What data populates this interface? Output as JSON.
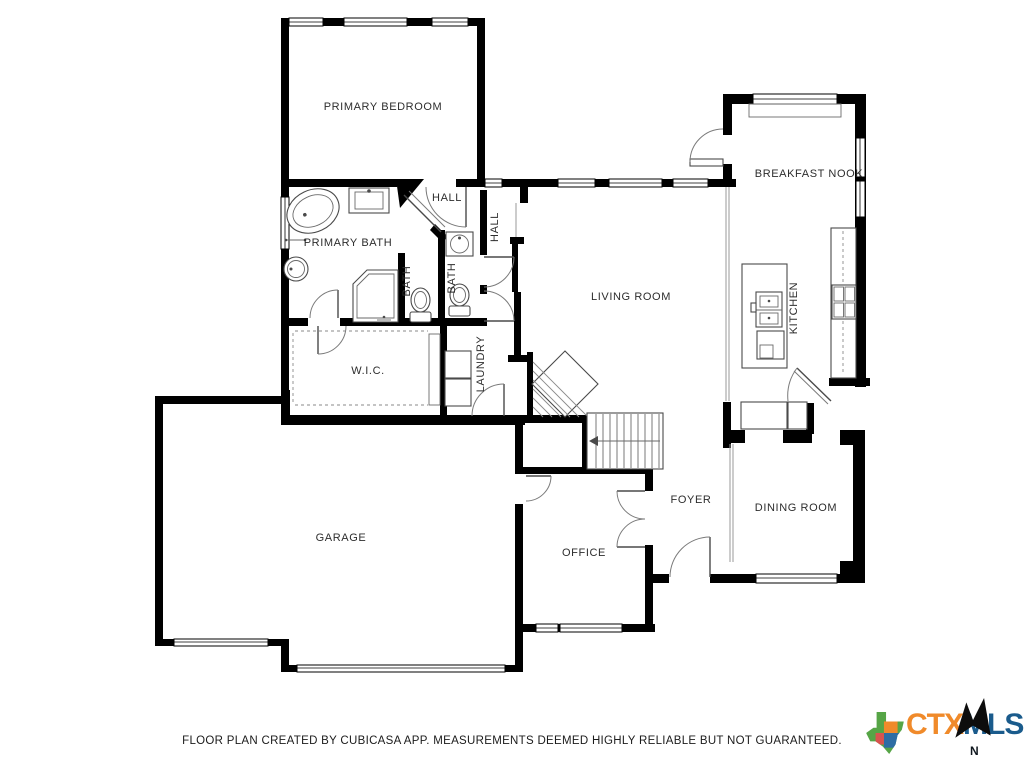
{
  "plan": {
    "rooms": {
      "primary_bedroom": "PRIMARY BEDROOM",
      "hall_upper": "HALL",
      "hall_side": "HALL",
      "primary_bath": "PRIMARY BATH",
      "bath_inner": "BATH",
      "bath_hall": "BATH",
      "living_room": "LIVING ROOM",
      "breakfast_nook": "BREAKFAST NOOK",
      "kitchen": "KITCHEN",
      "wic": "W.I.C.",
      "laundry": "LAUNDRY",
      "garage": "GARAGE",
      "office": "OFFICE",
      "foyer": "FOYER",
      "dining_room": "DINING ROOM"
    },
    "fixtures": [
      "bathtub",
      "shower",
      "toilet",
      "sink",
      "double-sink",
      "kitchen-island",
      "stove",
      "counter",
      "washer",
      "dryer",
      "staircase",
      "closet-shelving"
    ],
    "wall_color": "#000000",
    "background": "#ffffff"
  },
  "footer": {
    "disclaimer": "FLOOR PLAN CREATED BY CUBICASA APP. MEASUREMENTS DEEMED HIGHLY RELIABLE BUT NOT GUARANTEED."
  },
  "logo": {
    "prefix": "CTX",
    "suffix": "MLS",
    "compass_label": "N",
    "prefix_color": "#F08A2A",
    "suffix_color": "#1A5B8C",
    "texas_colors": [
      "#56A546",
      "#F08A2A",
      "#2E6DA4",
      "#D9534F"
    ]
  }
}
